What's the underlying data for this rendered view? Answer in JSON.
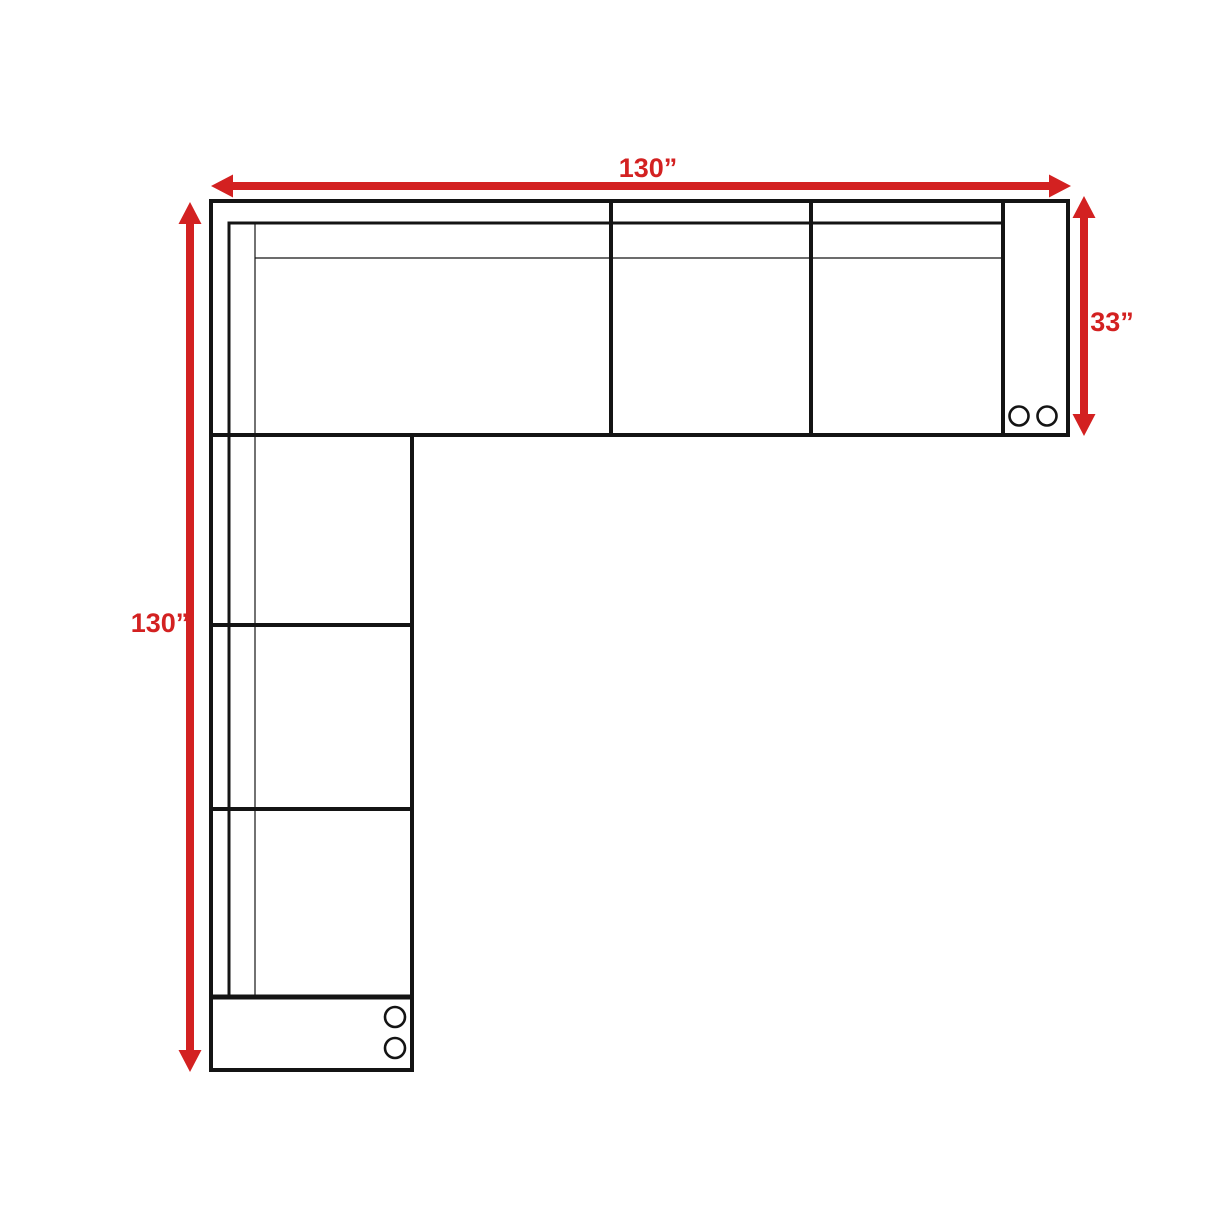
{
  "diagram": {
    "title": "sectional-sofa-dimension-plan",
    "dimensions": {
      "top_width_label": "130”",
      "left_height_label": "130”",
      "right_depth_label": "33”"
    },
    "colors": {
      "dimension_red": "#d32121",
      "line_black": "#141414",
      "background": "#ffffff"
    },
    "structure": {
      "top_row_seat_sections": 3,
      "left_column_seat_sections": 3,
      "corner_sections": 1,
      "armrest_sections": 2,
      "caster_circles": 4
    }
  }
}
